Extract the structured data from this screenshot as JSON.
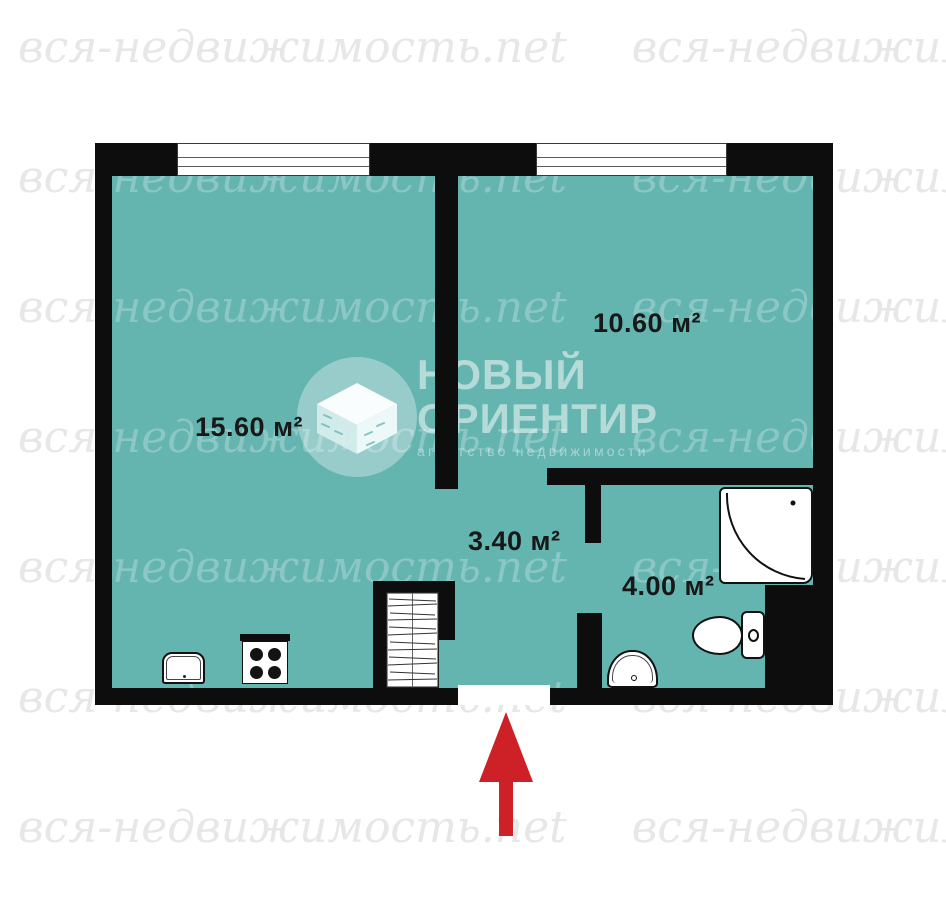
{
  "colors": {
    "room_fill": "#64b4b0",
    "wall": "#0d0d0d",
    "arrow": "#ce2027",
    "wm_gray": "#e7e7e7"
  },
  "watermark": {
    "text": "вся-недвижимость.net"
  },
  "logo": {
    "title_line1": "НОВЫЙ",
    "title_line2": "ОРИЕНТИР",
    "subtitle": "агентство недвижимости",
    "icon": "isometric-box-icon"
  },
  "floor_plan": {
    "rooms": [
      {
        "name": "living-room-kitchen",
        "area_label": "15.60 м²"
      },
      {
        "name": "room",
        "area_label": "10.60 м²"
      },
      {
        "name": "hallway",
        "area_label": "3.40 м²"
      },
      {
        "name": "bathroom",
        "area_label": "4.00 м²"
      }
    ],
    "windows": 2,
    "fixtures": [
      "kitchen-sink",
      "stove",
      "wardrobe",
      "corner-shower",
      "toilet",
      "bathroom-sink"
    ],
    "entrance_marker": "red-arrow-up"
  }
}
